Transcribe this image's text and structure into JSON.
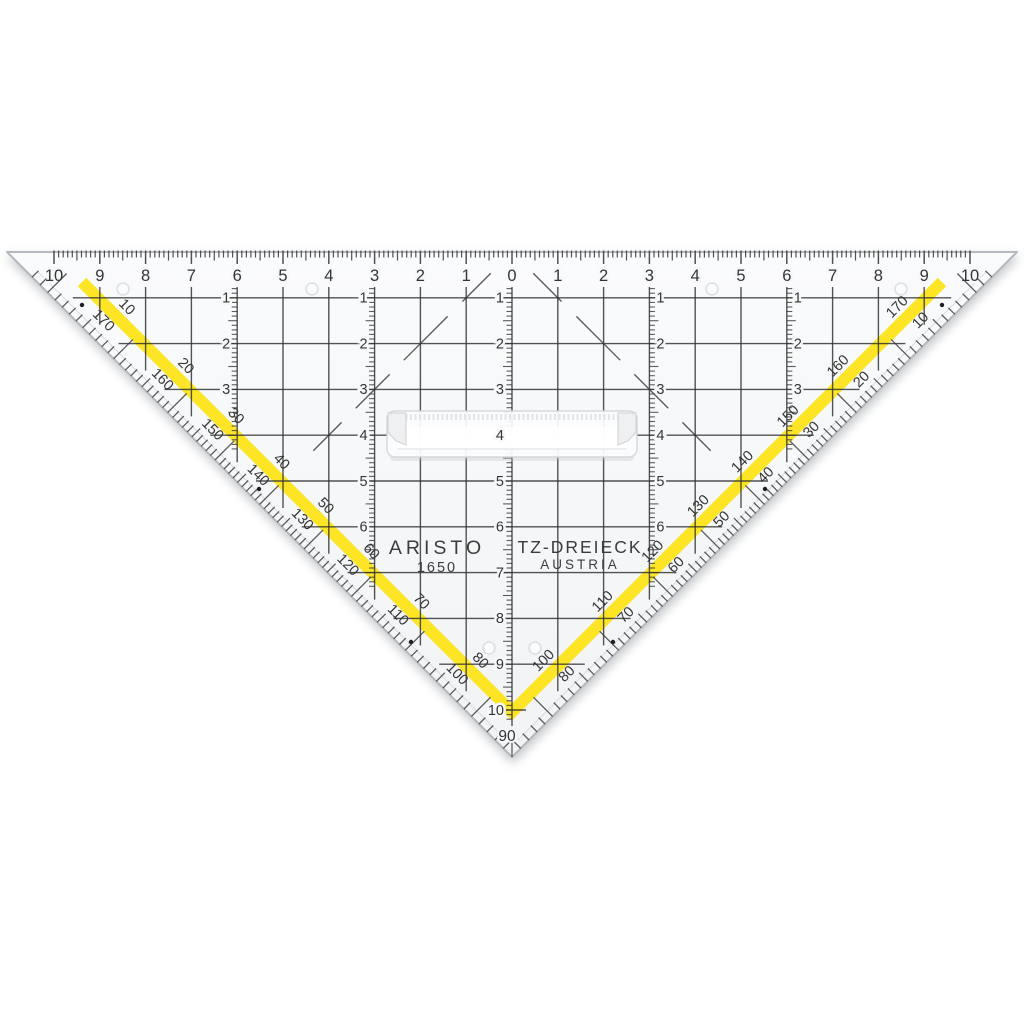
{
  "product": {
    "brand": "ARISTO",
    "model": "1650",
    "type": "TZ-DREIECK",
    "country": "AUSTRIA",
    "apex_angle_label": "90"
  },
  "colors": {
    "background": "#ffffff",
    "plastic_top": "#fafbfc",
    "plastic_bottom": "#f1f3f5",
    "ink": "#353535",
    "edge": "#b5b8bc",
    "bevel": "#dcdfe2",
    "stripe_yellow": "#fbe41a",
    "shadow": "#7d838a",
    "hole_ring": "#dde0e3",
    "handle_fill": "#fcfdfe",
    "handle_edge": "#d3d6d9"
  },
  "top_ruler": {
    "numbers": [
      10,
      9,
      8,
      7,
      6,
      5,
      4,
      3,
      2,
      1,
      0,
      1,
      2,
      3,
      4,
      5,
      6,
      7,
      8,
      9,
      10
    ],
    "mm_ticks_per_side": 100
  },
  "grid": {
    "vertical_lines_cm": [
      -9,
      -8,
      -7,
      -6,
      -5,
      -4,
      -3,
      -2,
      -1,
      0,
      1,
      2,
      3,
      4,
      5,
      6,
      7,
      8,
      9
    ],
    "horizontal_rows": [
      1,
      2,
      3,
      4,
      5,
      6,
      7,
      8,
      9
    ],
    "scale_columns": [
      {
        "x_cm": -6,
        "row_labels": [
          1,
          2,
          3
        ],
        "tick_end_y": 452
      },
      {
        "x_cm": -3,
        "row_labels": [
          1,
          2,
          3,
          4,
          5,
          6
        ],
        "tick_end_y": 588
      },
      {
        "x_cm": 0,
        "row_labels": [
          1,
          2,
          3,
          4,
          5,
          6,
          7,
          8,
          9,
          10
        ],
        "tick_end_y": 722
      },
      {
        "x_cm": 3,
        "row_labels": [
          1,
          2,
          3,
          4,
          5,
          6
        ],
        "tick_end_y": 588
      },
      {
        "x_cm": 6,
        "row_labels": [
          1,
          2,
          3
        ],
        "tick_end_y": 452
      }
    ]
  },
  "protractor": {
    "tick_step_deg": 1,
    "left_outer_labels": [
      100,
      110,
      120,
      130,
      140,
      150,
      160,
      170
    ],
    "left_inner_labels": [
      80,
      70,
      60,
      50,
      40,
      30,
      20,
      10
    ],
    "right_outer_labels": [
      10,
      20,
      30,
      40,
      50,
      60,
      70,
      80
    ],
    "right_inner_labels": [
      170,
      160,
      150,
      140,
      130,
      120,
      110,
      100
    ],
    "apex_label": "90"
  },
  "marks": {
    "dots": [
      [
        82,
        305
      ],
      [
        942,
        305
      ],
      [
        259,
        489
      ],
      [
        765,
        489
      ],
      [
        411,
        642
      ],
      [
        613,
        642
      ]
    ],
    "top_holes": [
      [
        123,
        289
      ],
      [
        312,
        289
      ],
      [
        712,
        289
      ],
      [
        901,
        289
      ]
    ],
    "apex_holes": [
      [
        489,
        648
      ],
      [
        535,
        648
      ]
    ]
  },
  "geometry": {
    "center_x": 512,
    "top_y": 252,
    "cm_px": 45.8,
    "half_base_px": 505,
    "apex": [
      512,
      757
    ],
    "tip_left": [
      7,
      252
    ],
    "tip_right": [
      1017,
      252
    ],
    "stripe_width": 12,
    "stripe_points": [
      [
        82,
        282
      ],
      [
        512,
        712
      ],
      [
        942,
        282
      ]
    ],
    "diagonal_guides": {
      "length": 312,
      "dash_pattern": "0 30 40 21 62 20 48 20 40 999"
    },
    "handle": {
      "x": 387,
      "y": 411,
      "w": 250,
      "h": 46
    }
  }
}
